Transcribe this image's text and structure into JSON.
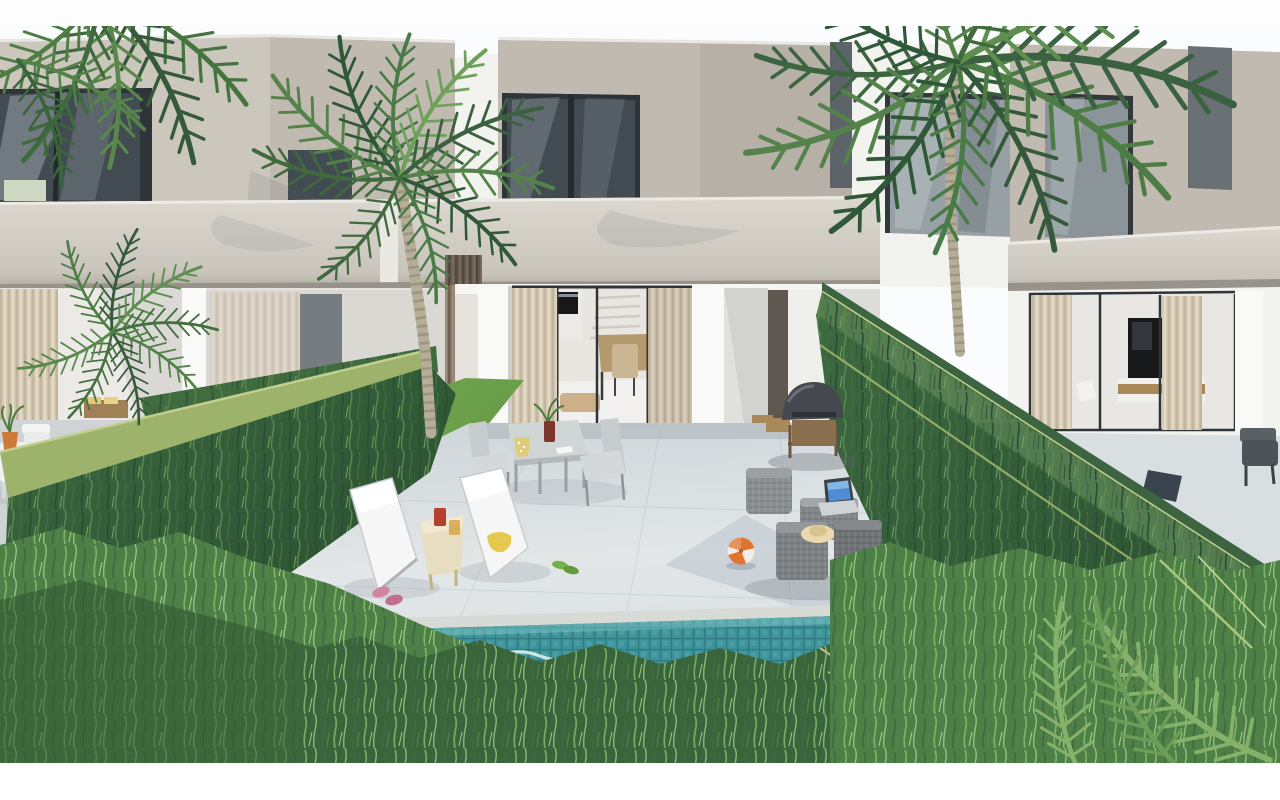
{
  "image": {
    "kind": "3d-architectural-render",
    "subject": "new-build modern two-storey villas with private landscaped gardens and pool",
    "view": "elevated exterior view of rear garden terrace",
    "lighting": "bright daylight"
  },
  "palette": {
    "sky": "#fbfcfd",
    "wall_beige": "#c0bab0",
    "wall_beige_light": "#ccc7bd",
    "wall_beige_dark": "#aaa497",
    "slab": "#d3cfc7",
    "white_wall": "#f2f2ef",
    "white_bright": "#f9f9f7",
    "white_shadow": "#dededa",
    "glass_dark": "#424b52",
    "glass_grey": "#97a0a4",
    "frame_dark": "#2f3439",
    "curtain_base": "#d8cdb9",
    "interior_back": "#e6e3de",
    "lawn": "#6ca048",
    "patio": "#dde2e4",
    "patio_shadow": "#c3cbd1",
    "coping": "#d7dad5",
    "pool_base": "#3f939a",
    "pool_grid": "#2c747d",
    "water_highlight": "#e8f6f2",
    "hedge_dark": "#30563a",
    "hedge_mid": "#44703f",
    "hedge_band": "#9db36b",
    "hedge_band_line": "#c2cf8f",
    "grass_bright": "#4e7f47",
    "grass_light": "#7ab364",
    "trunk": "#b6ad99",
    "frond_green": "#4a7a46",
    "wood": "#a98957",
    "tv_black": "#17181a",
    "bbq_dark": "#45494f",
    "wicker_grey": "#83878a",
    "laptop_screen": "#4f8cd3",
    "ball_orange": "#df7530",
    "hat_straw": "#ead9ac",
    "towel_yellow": "#e5c94f",
    "slipper_pink": "#d2849c",
    "sandal_green": "#76b14a",
    "vase_red": "#7e352b",
    "pot_orange": "#cf7a3a",
    "pot_yellow": "#e0cb79"
  },
  "scene": {
    "buildings": [
      {
        "name": "left-villa",
        "floors": 2,
        "features": [
          "dark corner window",
          "balcony slab",
          "ground-floor curtains",
          "neighbour patio with white dining set"
        ]
      },
      {
        "name": "center-villa",
        "floors": 2,
        "features": [
          "upper window",
          "cantilevered slab",
          "open sliding glass doors",
          "beige curtains",
          "interior oven, staircase and dining table"
        ]
      },
      {
        "name": "right-villa",
        "floors": 2,
        "features": [
          "reflective glass windows",
          "dark corner panel",
          "living room with TV",
          "patio chair"
        ]
      }
    ],
    "garden": {
      "pool": "teal mosaic-tiled private pool",
      "hedges": [
        "tall trimmed hedge left boundary",
        "tall trimmed hedge right boundary"
      ],
      "foreground": "feathery ornamental grasses",
      "palms": [
        "center areca palm",
        "right tall palm",
        "top-left palm fronds",
        "small left palm"
      ]
    },
    "objects": [
      "two white sun loungers",
      "wooden side table with red cup and drink",
      "outdoor dining table with plant vase and yellow pot",
      "two metal garden chairs",
      "barbecue grill with wooden cart",
      "grey wicker cube set",
      "open laptop with blue screen",
      "straw hat",
      "orange-white beach ball",
      "pink slippers",
      "green sandals",
      "yellow towel",
      "white neighbour dining set",
      "orange plant pot",
      "grey patio chair"
    ]
  }
}
